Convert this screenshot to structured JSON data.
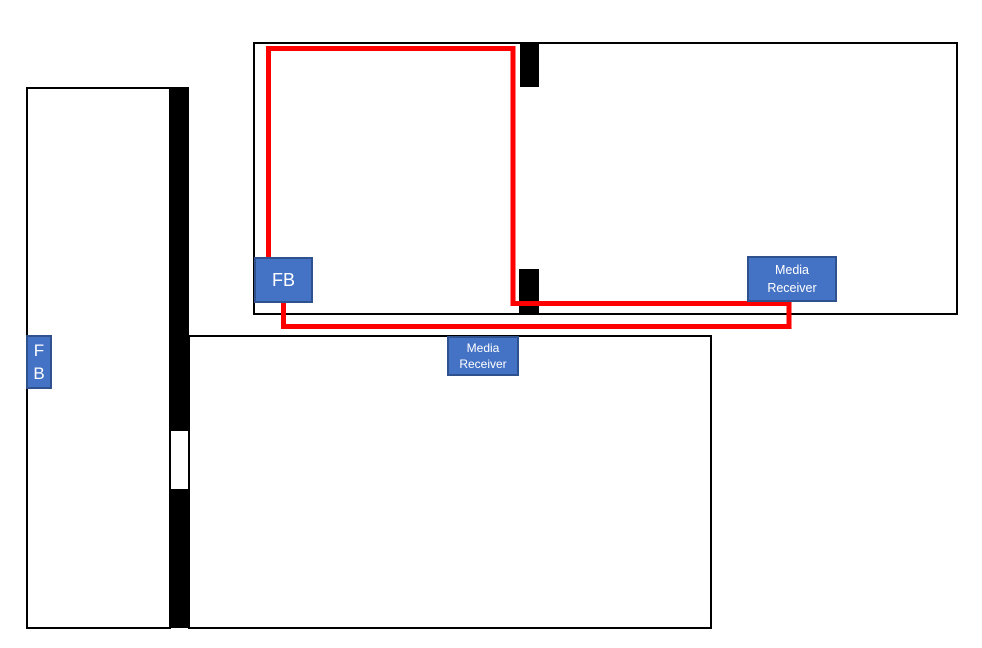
{
  "colors": {
    "box_fill": "#4472C4",
    "box_border": "#2F528F",
    "cable": "#FF0000",
    "wall": "#000000"
  },
  "boxes": {
    "fb_main": {
      "label": "FB"
    },
    "fb_side": {
      "lines": [
        "F",
        "B"
      ]
    },
    "media_receiver_top": {
      "lines": [
        "Media",
        "Receiver"
      ]
    },
    "media_receiver_bottom": {
      "lines": [
        "Media",
        "Receiver"
      ]
    }
  }
}
